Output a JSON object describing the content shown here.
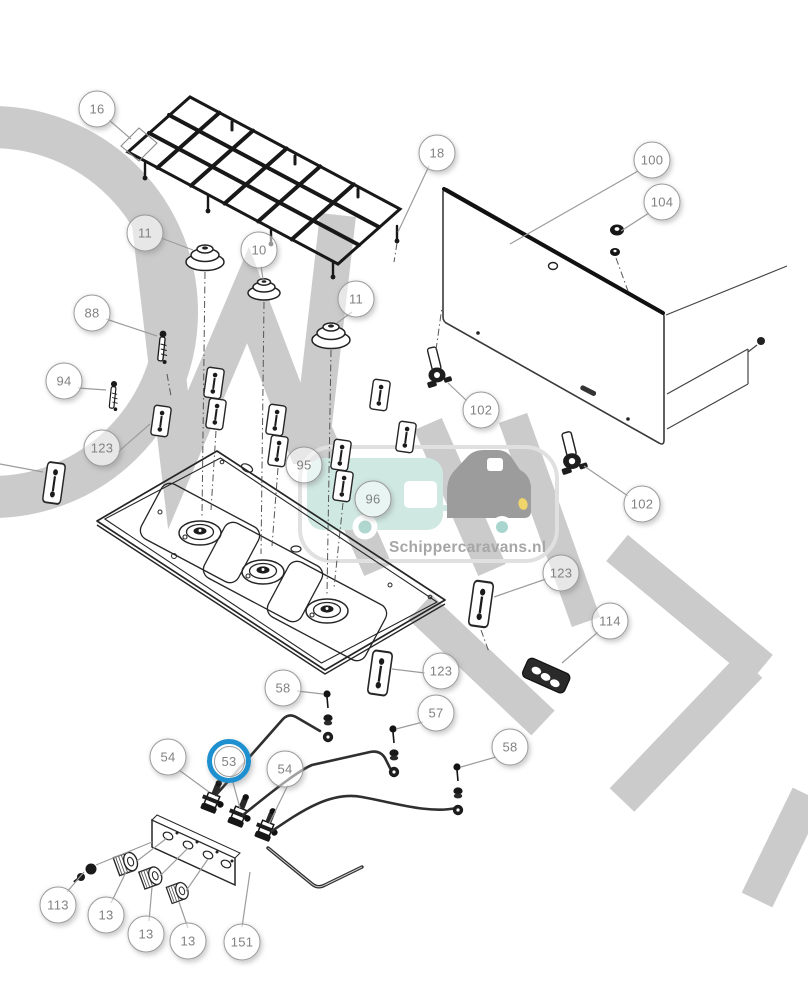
{
  "figure": {
    "watermark_site": "Schippercaravans.nl"
  },
  "colors": {
    "highlight_ring": "#1f90cf",
    "watermark_gray": "#cbcbcb",
    "logo_caravan_teal": "#cfe8e2",
    "logo_car_gray": "#9c9c9c",
    "logo_headlight_yellow": "#f0d56a",
    "logo_wheel_teal": "#a8d6cf",
    "line_art": "#262626",
    "callout_text": "#828282"
  },
  "callouts": [
    {
      "label": "16",
      "x": 97,
      "y": 109
    },
    {
      "label": "18",
      "x": 437,
      "y": 153
    },
    {
      "label": "100",
      "x": 652,
      "y": 160
    },
    {
      "label": "104",
      "x": 662,
      "y": 202
    },
    {
      "label": "11",
      "x": 145,
      "y": 233
    },
    {
      "label": "10",
      "x": 259,
      "y": 250
    },
    {
      "label": "11",
      "x": 356,
      "y": 299
    },
    {
      "label": "88",
      "x": 92,
      "y": 313
    },
    {
      "label": "94",
      "x": 64,
      "y": 381
    },
    {
      "label": "123",
      "x": 102,
      "y": 448
    },
    {
      "label": "102",
      "x": 481,
      "y": 410
    },
    {
      "label": "102",
      "x": 642,
      "y": 504
    },
    {
      "label": "95",
      "x": 304,
      "y": 465
    },
    {
      "label": "96",
      "x": 373,
      "y": 499
    },
    {
      "label": "123",
      "x": 561,
      "y": 573
    },
    {
      "label": "114",
      "x": 610,
      "y": 621
    },
    {
      "label": "123",
      "x": 441,
      "y": 671
    },
    {
      "label": "58",
      "x": 283,
      "y": 688
    },
    {
      "label": "57",
      "x": 436,
      "y": 713
    },
    {
      "label": "58",
      "x": 510,
      "y": 747
    },
    {
      "label": "54",
      "x": 168,
      "y": 757
    },
    {
      "label": "53",
      "x": 229,
      "y": 761,
      "highlighted": true
    },
    {
      "label": "54",
      "x": 285,
      "y": 769
    },
    {
      "label": "113",
      "x": 58,
      "y": 905
    },
    {
      "label": "13",
      "x": 106,
      "y": 915
    },
    {
      "label": "13",
      "x": 146,
      "y": 934
    },
    {
      "label": "13",
      "x": 188,
      "y": 941
    },
    {
      "label": "151",
      "x": 242,
      "y": 942
    }
  ]
}
